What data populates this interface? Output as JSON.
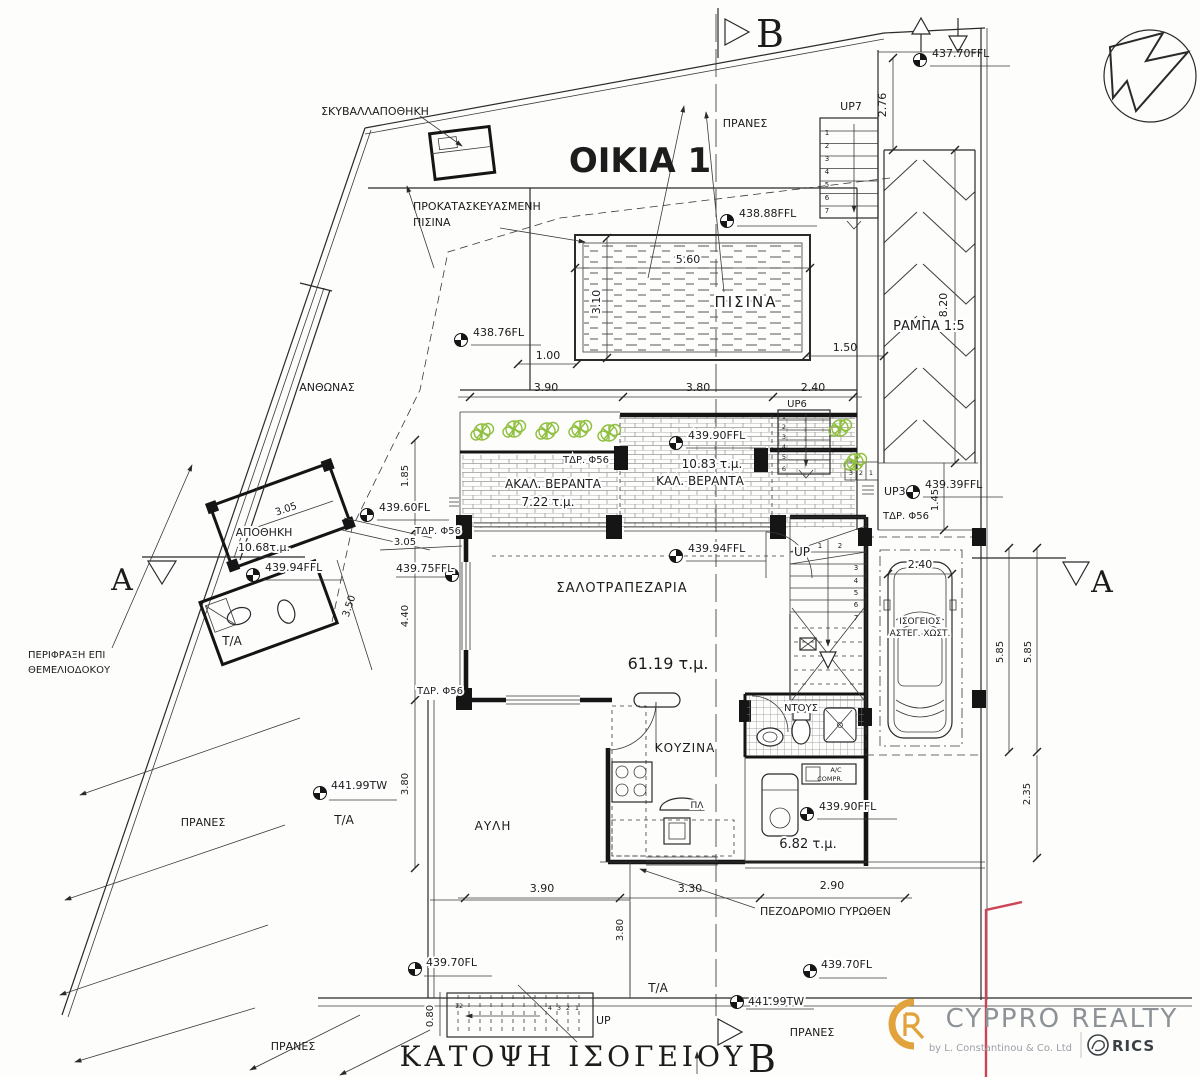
{
  "meta": {
    "house_title": "ΟΙΚΙΑ 1",
    "plan_title": "ΚΑΤΟΨΗ ΙΣΟΓΕΙΟΥ"
  },
  "sections": {
    "a": "A",
    "b": "B"
  },
  "rooms": {
    "pool": "ΠΙΣΙΝΑ",
    "pool_note_line1": "ΠΡΟΚΑΤΑΣΚΕΥΑΣΜΕΝΗ",
    "pool_note_line2": "ΠΙΣΙΝΑ",
    "living": "ΣΑΛΟΤΡΑΠΕΖΑΡΙΑ",
    "living_area": "61.19 τ.μ.",
    "kitchen": "ΚΟΥΖΙΝΑ",
    "shower": "ΝΤΟΥΣ",
    "utility_area": "6.82 τ.μ.",
    "yard": "ΑΥΛΗ",
    "storage": "ΑΠΟΘΗΚΗ",
    "storage_area": "10.68τ.μ.",
    "planter": "ΑΝΘΩΝΑΣ",
    "bin_store": "ΣΚΥΒΑΛΛΑΠΟΘΗΚΗ",
    "cov_veranda": "ΚΑΛ. ΒΕΡΑΝΤΑ",
    "cov_veranda_area": "10.83 τ.μ.",
    "uncov_veranda": "ΑΚΑΛ. ΒΕΡΑΝΤΑ",
    "uncov_veranda_area": "7.22 τ.μ.",
    "ramp": "ΡΑΜΠΑ 1:5",
    "parking_line1": "ΙΣΟΓΕΙΟΣ",
    "parking_line2": "ΑΣΤΕΓ. ΧΩΣΤ.",
    "ac_line1": "A/C",
    "ac_line2": "COMPR.",
    "basin": "ΠΛ"
  },
  "site": {
    "slope": "ΠΡΑΝΕΣ",
    "ta": "Τ/Α",
    "fence_line1": "ΠΕΡΙΦΡΑΞΗ ΕΠΙ",
    "fence_line2": "ΘΕΜΕΛΙΟΔΟΚΟΥ",
    "sidewalk": "ΠΕΖΟΔΡΟΜΙΟ ΓΥΡΩΘΕΝ",
    "drain": "ΤΔΡ. Φ56"
  },
  "levels": {
    "lv437_70": "437.70FFL",
    "lv438_88": "438.88FFL",
    "lv438_76": "438.76FL",
    "lv439_90": "439.90FFL",
    "lv439_39": "439.39FFL",
    "lv439_60": "439.60FL",
    "lv439_94": "439.94FFL",
    "lv439_75": "439.75FFL",
    "lv439_70": "439.70FL",
    "lv441_99": "441.99TW"
  },
  "dims": {
    "d080": "0.80",
    "d100": "1.00",
    "d145": "1.45",
    "d150": "1.50",
    "d185": "1.85",
    "d235": "2.35",
    "d240": "2.40",
    "d276": "2.76",
    "d290": "2.90",
    "d305": "3.05",
    "d310": "3.10",
    "d330": "3.30",
    "d350": "3.50",
    "d380": "3.80",
    "d390": "3.90",
    "d440": "4.40",
    "d560": "5.60",
    "d585": "5.85",
    "d820": "8.20"
  },
  "stairs": {
    "up7": "UP7",
    "up6": "UP6",
    "up3": "UP3",
    "up": "UP",
    "n1": "1",
    "n2": "2",
    "n3": "3",
    "n4": "4",
    "n5": "5",
    "n6": "6",
    "n7": "7",
    "n12": "12"
  },
  "logo": {
    "brand": "CYPPRO REALTY",
    "byline": "by L. Constantinou & Co. Ltd",
    "rics": "RICS"
  },
  "colors": {
    "ink": "#222222",
    "plant_green": "#8fbf3f",
    "brand_orange": "#e2a23c",
    "brand_gray": "#8d9296",
    "boundary_red": "#cc4455"
  }
}
